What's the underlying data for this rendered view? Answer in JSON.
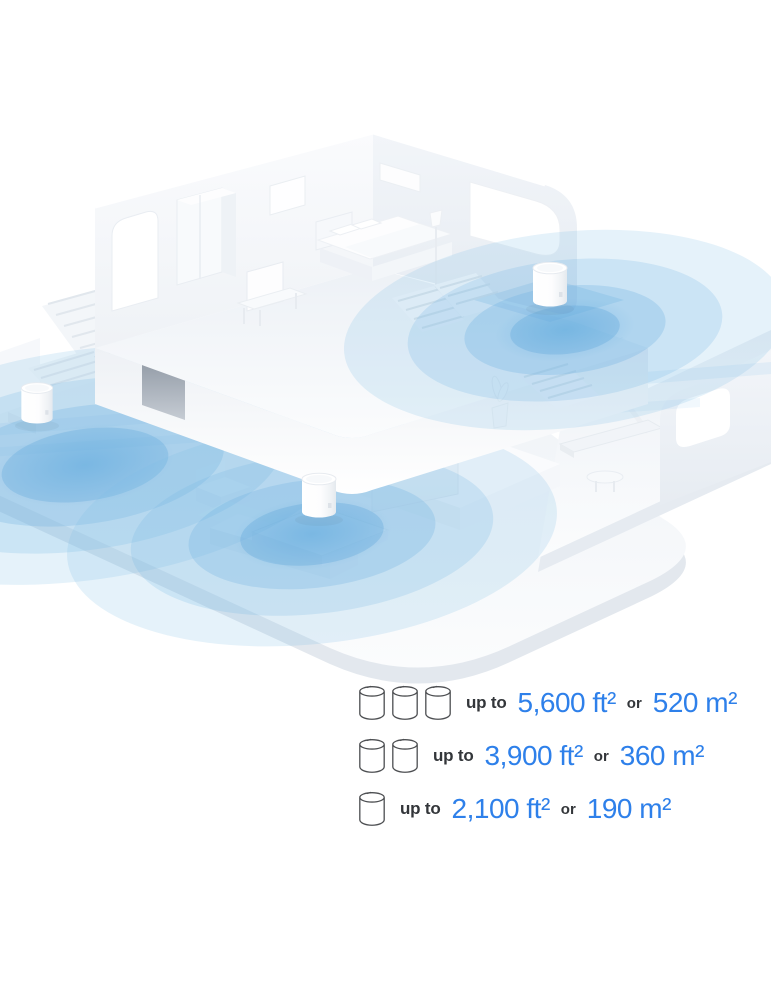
{
  "page": {
    "background": "#ffffff",
    "width": 771,
    "height": 1000
  },
  "illustration": {
    "name": "isometric-home-mesh-wifi-coverage",
    "description": "Isometric cutaway of a two-story white home with three mesh Wi-Fi units emitting concentric blue coverage circles",
    "device_count": 3,
    "device_icon": "deco-cylinder-router",
    "colors": {
      "coverage_blue": "#7ab6e6",
      "floor_white": "#f2f5f9",
      "wall_shade": "#e7ecf2"
    }
  },
  "legend": {
    "accent_color": "#2e80ea",
    "text_color": "#33363a",
    "rows": [
      {
        "units": 3,
        "prefix": "up to",
        "imperial": "5,600 ft²",
        "conjunction": "or",
        "metric": "520 m²"
      },
      {
        "units": 2,
        "prefix": "up to",
        "imperial": "3,900 ft²",
        "conjunction": "or",
        "metric": "360 m²"
      },
      {
        "units": 1,
        "prefix": "up to",
        "imperial": "2,100 ft²",
        "conjunction": "or",
        "metric": "190 m²"
      }
    ]
  }
}
